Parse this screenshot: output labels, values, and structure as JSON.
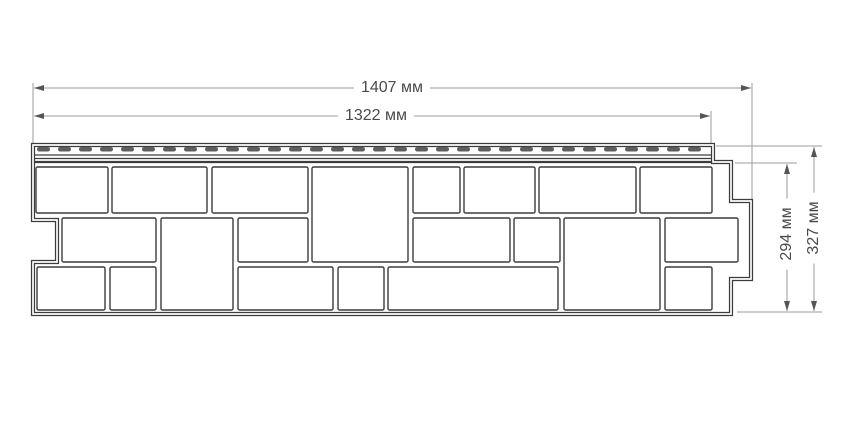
{
  "figure": {
    "description": "Technical drawing of a facade siding panel with stone-block pattern, perforated nailing strip and stepped interlock edges",
    "units": "мм"
  },
  "dimensions": {
    "total_width": {
      "label": "1407 мм",
      "value": 1407
    },
    "nailing_width": {
      "label": "1322 мм",
      "value": 1322
    },
    "body_height": {
      "label": "294 мм",
      "value": 294
    },
    "total_height": {
      "label": "327 мм",
      "value": 327
    }
  },
  "colors": {
    "outline": "#3c3c3c",
    "stone_stroke": "#3c3c3c",
    "perforation": "#5e5e5e",
    "dim_line": "#9b9b9b",
    "arrow": "#555555",
    "text": "#4a4a4a",
    "background": "#ffffff"
  },
  "drawing": {
    "outline_path": "M 33,145 L 713,145 L 713,162 L 731,162 L 731,201 L 751,201 L 751,279 L 731,279 L 731,314 L 33,314 L 33,262 L 57,262 L 57,220 L 33,220 Z",
    "strip_lines": [
      {
        "x1": 34,
        "x2": 712,
        "y": 155,
        "w": 1.2
      },
      {
        "x1": 34,
        "x2": 712,
        "y": 158.5,
        "w": 1.2
      },
      {
        "x1": 34,
        "x2": 712,
        "y": 162,
        "w": 2.2
      }
    ],
    "perforations": {
      "x_start": 37,
      "x_end": 708,
      "step": 21,
      "dash_w": 13,
      "dash_h": 4.5,
      "y": 147,
      "rx": 2.2
    },
    "stones": [
      [
        36,
        167,
        72,
        46
      ],
      [
        112,
        167,
        95,
        46
      ],
      [
        212,
        167,
        96,
        46
      ],
      [
        312,
        167,
        96,
        95
      ],
      [
        413,
        167,
        47,
        46
      ],
      [
        464,
        167,
        71,
        46
      ],
      [
        539,
        167,
        97,
        46
      ],
      [
        640,
        167,
        72,
        46
      ],
      [
        62,
        218,
        94,
        44
      ],
      [
        161,
        218,
        72,
        92
      ],
      [
        238,
        218,
        70,
        44
      ],
      [
        413,
        218,
        97,
        44
      ],
      [
        514,
        218,
        46,
        44
      ],
      [
        564,
        218,
        96,
        92
      ],
      [
        665,
        218,
        73,
        44
      ],
      [
        37,
        267,
        68,
        43
      ],
      [
        110,
        267,
        46,
        43
      ],
      [
        238,
        267,
        95,
        43
      ],
      [
        338,
        267,
        46,
        43
      ],
      [
        388,
        267,
        170,
        43
      ],
      [
        665,
        267,
        47,
        43
      ]
    ],
    "dim_lines": [
      {
        "name": "total-width",
        "type": "h",
        "y": 88,
        "x1": 34,
        "x2": 751
      },
      {
        "name": "nailing-width",
        "type": "h",
        "y": 116,
        "x1": 34,
        "x2": 710
      },
      {
        "name": "body-height",
        "type": "v",
        "x": 787,
        "y1": 164,
        "y2": 311
      },
      {
        "name": "total-height",
        "type": "v",
        "x": 814,
        "y1": 147,
        "y2": 311
      }
    ],
    "ext_lines": [
      [
        33,
        83,
        33,
        143
      ],
      [
        752,
        83,
        752,
        200
      ],
      [
        711,
        111,
        711,
        144
      ],
      [
        716,
        146,
        822,
        146
      ],
      [
        735,
        163,
        797,
        163
      ],
      [
        737,
        312,
        822,
        312
      ]
    ],
    "label_anchors": {
      "total_width": {
        "x": 392,
        "y": 88,
        "rotated": false
      },
      "nailing_width": {
        "x": 376,
        "y": 116,
        "rotated": false
      },
      "body_height": {
        "x": 787,
        "y": 234,
        "rotated": true
      },
      "total_height": {
        "x": 814,
        "y": 228,
        "rotated": true
      }
    }
  }
}
